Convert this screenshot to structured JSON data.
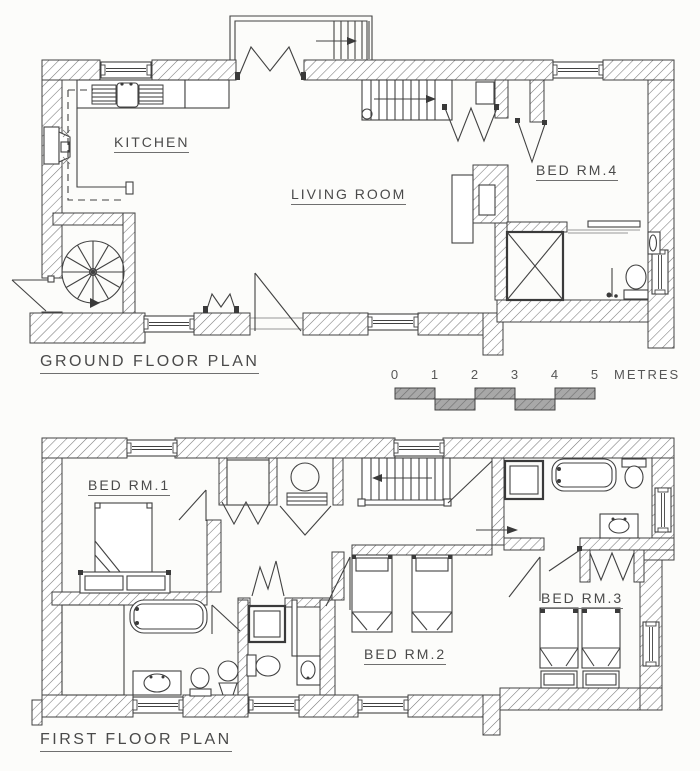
{
  "ground_floor": {
    "title": "GROUND FLOOR PLAN",
    "rooms": [
      {
        "label": "KITCHEN"
      },
      {
        "label": "LIVING ROOM"
      },
      {
        "label": "BED RM.4"
      }
    ]
  },
  "first_floor": {
    "title": "FIRST FLOOR PLAN",
    "rooms": [
      {
        "label": "BED RM.1"
      },
      {
        "label": "BED RM.2"
      },
      {
        "label": "BED RM.3"
      }
    ]
  },
  "scale_bar": {
    "ticks": [
      "0",
      "1",
      "2",
      "3",
      "4",
      "5"
    ],
    "unit": "METRES"
  },
  "colors": {
    "background": "#fcfcfa",
    "line": "#424242",
    "hatch": "#777777",
    "scale_fill": "#a8a8a8",
    "text": "#4a4a4a"
  }
}
